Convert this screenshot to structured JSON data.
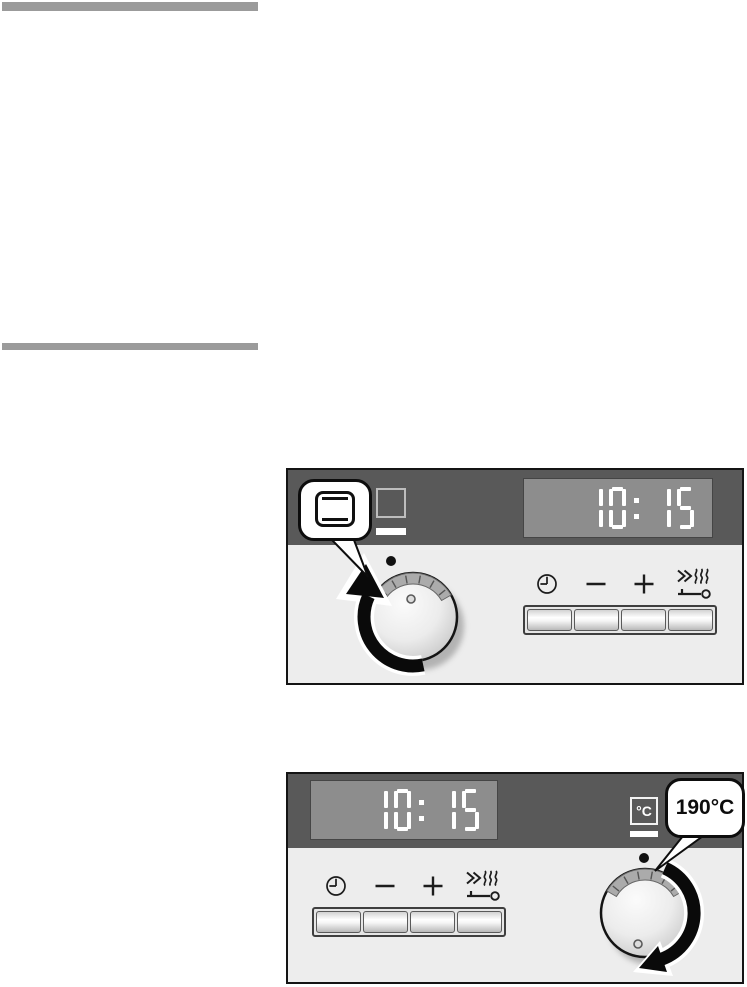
{
  "colors": {
    "section_rule": "#9b9b9b",
    "fascia_dark": "#595959",
    "fascia_light": "#ededed",
    "display_background": "#8d8d8d",
    "display_digits": "#ffffff"
  },
  "panel_function": {
    "name": "oven function selection panel",
    "display_time": "10:15",
    "callout_symbol": "top-bottom-heat-icon",
    "fascia_symbol": "oven-function-square-icon",
    "knob_rotation": "clockwise",
    "buttons": [
      {
        "name": "timer-button",
        "icon": "clock-icon"
      },
      {
        "name": "minus-button",
        "icon": "minus-icon"
      },
      {
        "name": "plus-button",
        "icon": "plus-icon"
      },
      {
        "name": "rapid-heat-childlock-button",
        "icon": "rapid-heat-key-icon"
      }
    ]
  },
  "panel_temperature": {
    "name": "temperature selection panel",
    "display_time": "10:15",
    "temp_unit_symbol": "°C",
    "callout_label": "190°C",
    "knob_rotation": "clockwise",
    "buttons": [
      {
        "name": "timer-button",
        "icon": "clock-icon"
      },
      {
        "name": "minus-button",
        "icon": "minus-icon"
      },
      {
        "name": "plus-button",
        "icon": "plus-icon"
      },
      {
        "name": "rapid-heat-childlock-button",
        "icon": "rapid-heat-key-icon"
      }
    ]
  }
}
